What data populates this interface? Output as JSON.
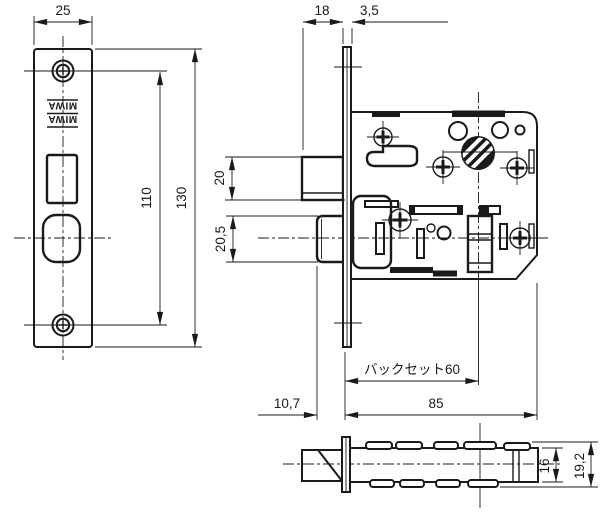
{
  "colors": {
    "line": "#1a1a1a",
    "background": "#ffffff"
  },
  "stamp": {
    "line1": "MIWA",
    "line2": "MIWA"
  },
  "dims": {
    "front_plate_width": "25",
    "front_screw_pitch": "110",
    "front_plate_height": "130",
    "latch_projection": "18",
    "plate_thickness": "3,5",
    "latch_height": "20",
    "deadbolt_height": "20,5",
    "backset": "バックセット60",
    "deadbolt_projection": "10,7",
    "case_depth": "85",
    "case_height": "16",
    "overall_height": "19,2"
  }
}
